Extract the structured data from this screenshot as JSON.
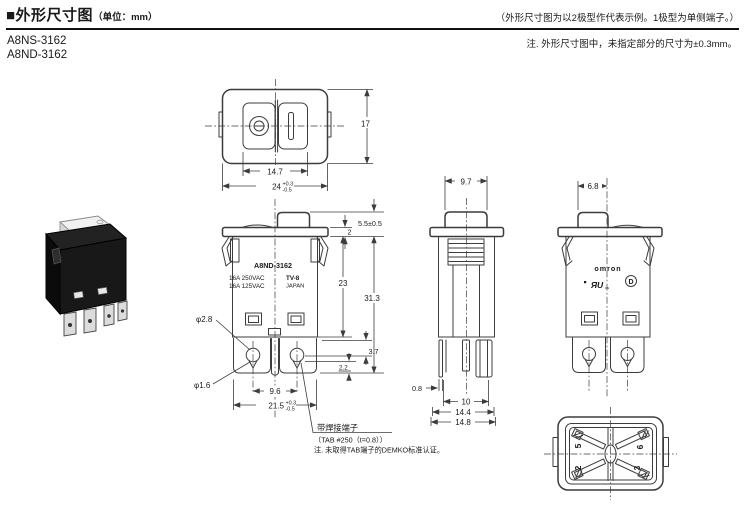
{
  "header": {
    "title": "■外形尺寸图",
    "unit": "（单位：mm）",
    "right_note": "（外形尺寸图为以2极型作代表示例。1极型为单侧端子。）",
    "tolerance_note": "注. 外形尺寸图中，未指定部分的尺寸为±0.3mm。"
  },
  "models": [
    "A8NS-3162",
    "A8ND-3162"
  ],
  "colors": {
    "line": "#3c3c3c",
    "text": "#1a1a1a",
    "background": "#ffffff"
  },
  "drawing": {
    "top_view": {
      "dim_inner": "14.7",
      "dim_width": "24",
      "dim_width_tol_plus": "+0.3",
      "dim_width_tol_minus": "-0.5",
      "dim_depth": "17"
    },
    "front_view": {
      "marking_model": "A8ND-3162",
      "marking_rating1": "16A 250VAC",
      "marking_rating2": "16A 125VAC",
      "marking_tv": "TV-8",
      "marking_origin": "JAPAN",
      "dim_actuator": "5.5±0.5",
      "dim_flange": "2",
      "dim_body": "23",
      "dim_total": "31.3",
      "dim_hole_large": "φ2.8",
      "dim_hole_small": "φ1.6",
      "dim_step": "3.7",
      "dim_step2": "2.2",
      "dim_pitch": "9.6",
      "dim_mount": "21.5",
      "dim_mount_tol_plus": "+0.3",
      "dim_mount_tol_minus": "-0.5"
    },
    "side_view": {
      "dim_rocker": "9.7",
      "dim_tab": "0.8",
      "dim_pitch": "10",
      "dim_body": "14.4",
      "dim_overall": "14.8"
    },
    "back_view": {
      "dim_rocker": "6.8",
      "marking_brand": "omron",
      "marking_ul": "ЯU",
      "marking_ul_sub": "us",
      "marking_demko": "D"
    },
    "bottom_view": {
      "terminals": [
        "5",
        "6",
        "2",
        "3"
      ]
    },
    "terminal_note": {
      "line1": "带焊接端子",
      "line2": "（TAB #250（t=0.8））",
      "line3": "注. 未取得TAB端子的DEMKO标准认证。"
    }
  }
}
